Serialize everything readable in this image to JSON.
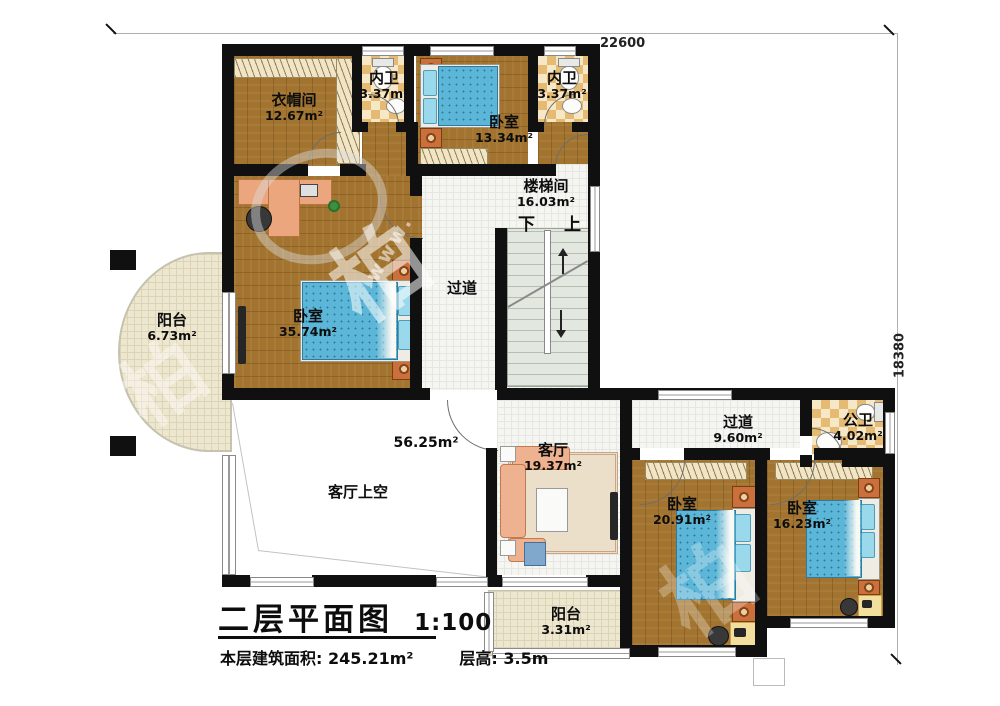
{
  "plan": {
    "dimensions": {
      "top": "22600",
      "right": "18380"
    },
    "title": {
      "text": "二层平面图",
      "scale": "1:100"
    },
    "info": {
      "floor_area": "本层建筑面积: 245.21m²",
      "floor_height": "层高: 3.5m"
    },
    "rooms": {
      "cloakroom": {
        "name": "衣帽间",
        "area": "12.67m²"
      },
      "ensuite_left": {
        "name": "内卫",
        "area": "3.37m²"
      },
      "bedroom_top": {
        "name": "卧室",
        "area": "13.34m²"
      },
      "ensuite_right": {
        "name": "内卫",
        "area": "3.37m²"
      },
      "stairwell": {
        "name": "楼梯间",
        "area": "16.03m²",
        "down": "下",
        "up": "上"
      },
      "master_bedroom": {
        "name": "卧室",
        "area": "35.74m²"
      },
      "corridor_mid": {
        "name": "过道"
      },
      "balcony_left": {
        "name": "阳台",
        "area": "6.73m²"
      },
      "living_void": {
        "name": "客厅上空",
        "area": "56.25m²"
      },
      "living": {
        "name": "客厅",
        "area": "19.37m²"
      },
      "corridor_right": {
        "name": "过道",
        "area": "9.60m²"
      },
      "public_bath": {
        "name": "公卫",
        "area": "4.02m²"
      },
      "bedroom_sw": {
        "name": "卧室",
        "area": "20.91m²"
      },
      "bedroom_se": {
        "name": "卧室",
        "area": "16.23m²"
      },
      "balcony_bottom": {
        "name": "阳台",
        "area": "3.31m²"
      }
    },
    "colors": {
      "wall": "#101010",
      "wood": "#a2742f",
      "bed_blue": "#5cb6d7",
      "tile_accent": "#e5ba72",
      "stair": "#e2e7df"
    },
    "watermark": {
      "marks": [
        "柏",
        "柏",
        "柏"
      ],
      "url_fragment": "www."
    }
  }
}
